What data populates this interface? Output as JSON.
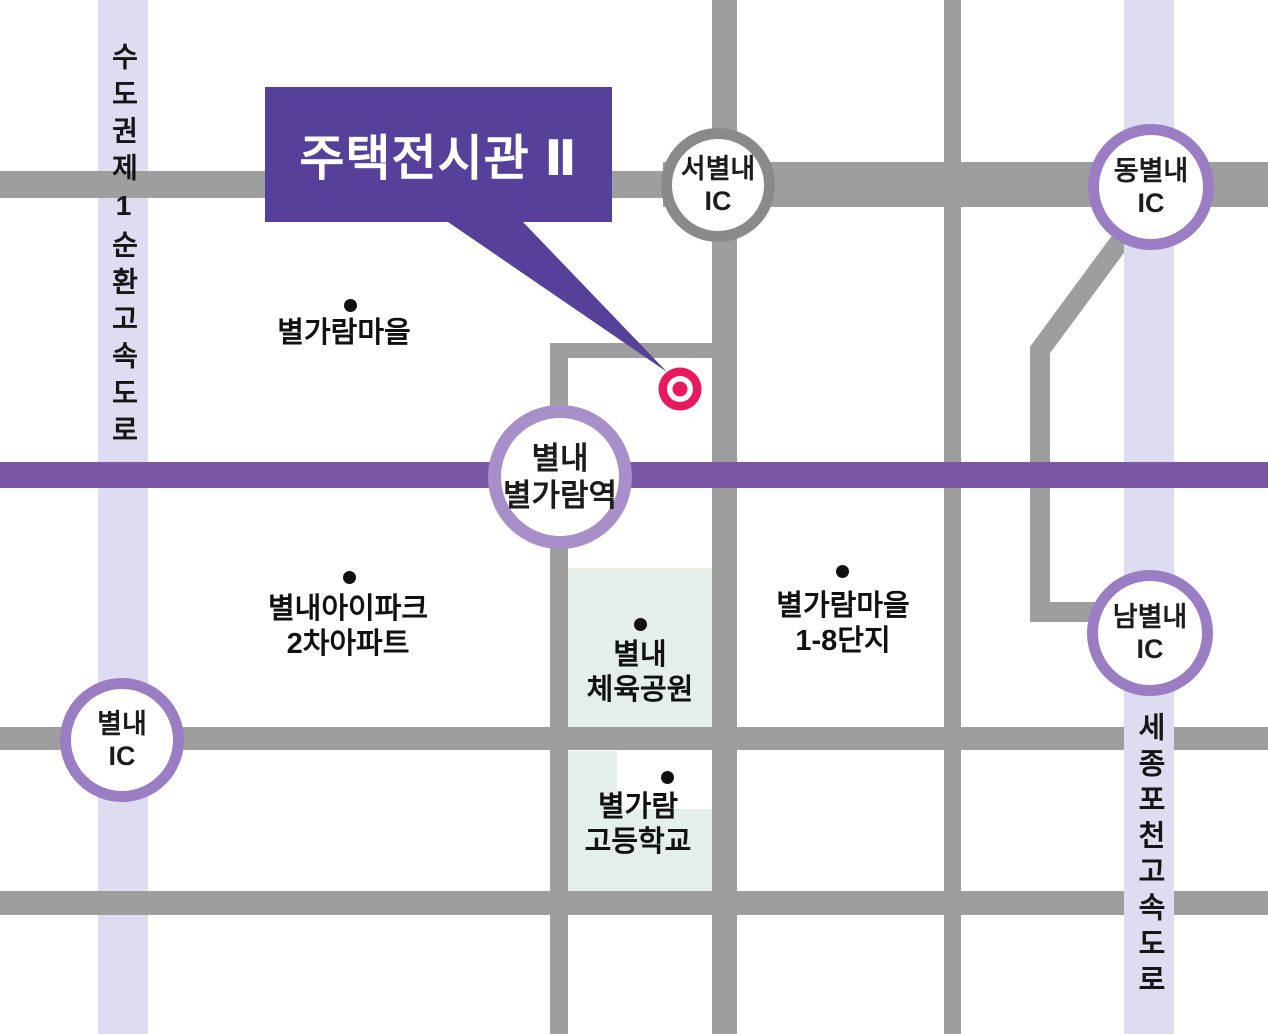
{
  "banner": {
    "label": "주택전시관 Ⅱ"
  },
  "expressways": {
    "left_label": "수도권제1순환고속도로",
    "right_label": "세종포천고속도로"
  },
  "station": {
    "line1": "별내",
    "line2": "별가람역"
  },
  "interchanges": {
    "west": {
      "name": "서별내",
      "suffix": "IC"
    },
    "east": {
      "name": "동별내",
      "suffix": "IC"
    },
    "south": {
      "name": "남별내",
      "suffix": "IC"
    },
    "byeollae": {
      "name": "별내",
      "suffix": "IC"
    }
  },
  "pois": {
    "byeolgaram_village": {
      "line1": "별가람마을"
    },
    "ipark_apt": {
      "line1": "별내아이파크",
      "line2": "2차아파트"
    },
    "sports_park": {
      "line1": "별내",
      "line2": "체육공원"
    },
    "village_complex": {
      "line1": "별가람마을",
      "line2": "1-8단지"
    },
    "high_school": {
      "line1": "별가람",
      "line2": "고등학교"
    }
  },
  "colors": {
    "banner_purple": "#56409a",
    "subway_line_purple": "#7b56a5",
    "ic_ring_purple": "#9a7dc3",
    "station_ring_purple": "#a88fc9",
    "west_ic_ring_gray": "#8a8a8a",
    "road_gray": "#9e9e9e",
    "expressway_lavender": "#dedcf0",
    "park_green": "#e4eeeb",
    "marker_red": "#e8195c"
  }
}
